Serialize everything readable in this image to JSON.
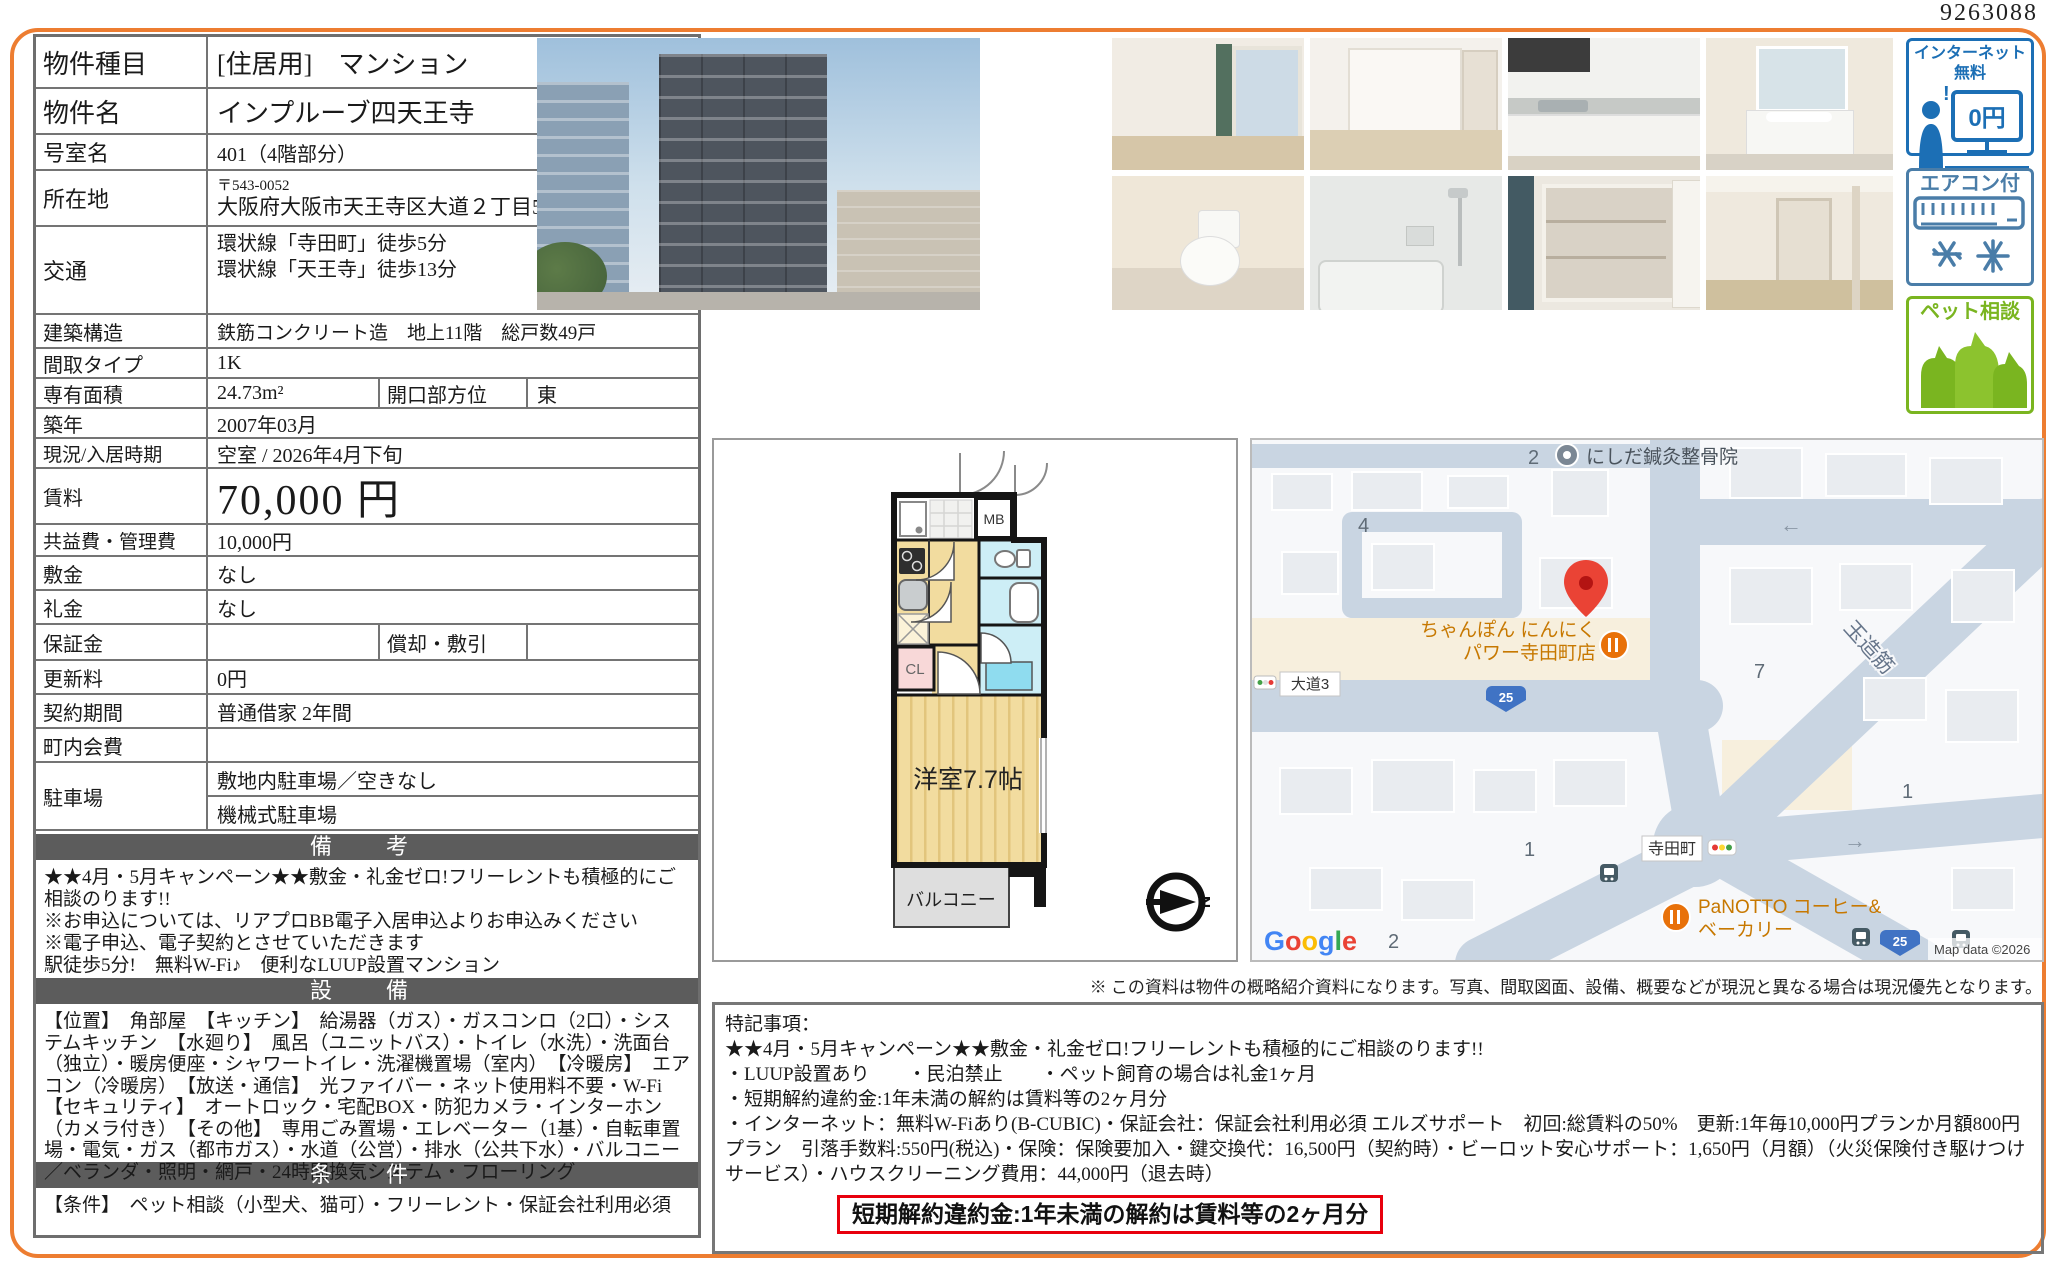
{
  "doc_number": "9263088",
  "table": {
    "property_type": {
      "label": "物件種目",
      "value": "[住居用]　マンション"
    },
    "property_name": {
      "label": "物件名",
      "value": "インプルーブ四天王寺"
    },
    "room_no": {
      "label": "号室名",
      "value": "401（4階部分）"
    },
    "address": {
      "label": "所在地",
      "postal": "〒543-0052",
      "value": "大阪府大阪市天王寺区大道２丁目5-3"
    },
    "access": {
      "label": "交通",
      "line1": "環状線「寺田町」徒歩5分",
      "line2": "環状線「天王寺」徒歩13分"
    },
    "structure": {
      "label": "建築構造",
      "value": "鉄筋コンクリート造　地上11階　総戸数49戸"
    },
    "layout_type": {
      "label": "間取タイプ",
      "value": "1K"
    },
    "area": {
      "label": "専有面積",
      "value": "24.73m²",
      "label2": "開口部方位",
      "value2": "東"
    },
    "built": {
      "label": "築年",
      "value": "2007年03月"
    },
    "status": {
      "label": "現況/入居時期",
      "value": "空室 /  2026年4月下旬"
    },
    "rent": {
      "label": "賃料",
      "value": "70,000 円"
    },
    "fees": {
      "label": "共益費・管理費",
      "value": "10,000円"
    },
    "deposit": {
      "label": "敷金",
      "value": "なし"
    },
    "key_money": {
      "label": "礼金",
      "value": "なし"
    },
    "guarantee": {
      "label": "保証金",
      "value": "",
      "label2": "償却・敷引",
      "value2": ""
    },
    "renewal_fee": {
      "label": "更新料",
      "value": "0円"
    },
    "contract": {
      "label": "契約期間",
      "value": "普通借家 2年間"
    },
    "town_fee": {
      "label": "町内会費",
      "value": ""
    },
    "parking": {
      "label": "駐車場",
      "value1": "敷地内駐車場／空きなし",
      "value2": "機械式駐車場"
    }
  },
  "sections": {
    "remarks_title": "備　考",
    "equipment_title": "設　備",
    "conditions_title": "条　件"
  },
  "remarks": {
    "lines": [
      "★★4月・5月キャンペーン★★敷金・礼金ゼロ!フリーレントも積極的にご相談のります!!",
      "※お申込については、リアプロBB電子入居申込よりお申込みください",
      "※電子申込、電子契約とさせていただきます",
      "駅徒歩5分!　無料W-Fi♪　便利なLUUP設置マンション"
    ]
  },
  "equipment": {
    "text": "【位置】　角部屋　【キッチン】　給湯器（ガス）・ガスコンロ（2口）・システムキッチン　【水廻り】　風呂（ユニットバス）・トイレ（水洗）・洗面台（独立）・暖房便座・シャワートイレ・洗濯機置場（室内）　【冷暖房】　エアコン（冷暖房）　【放送・通信】　光ファイバー・ネット使用料不要・W-Fi　【セキュリティ】　オートロック・宅配BOX・防犯カメラ・インターホン（カメラ付き）　【その他】　専用ごみ置場・エレベーター（1基）・自転車置場・電気・ガス（都市ガス）・水道（公営）・排水（公共下水）・バルコニー／ベランダ・照明・網戸・24時間換気システム・フローリング"
  },
  "conditions": {
    "text": "【条件】　ペット相談（小型犬、猫可）・フリーレント・保証会社利用必須"
  },
  "badges": {
    "internet": {
      "label": "インターネット無料",
      "monitor_text": "0円",
      "color": "#1c6fb5"
    },
    "aircon": {
      "label": "エアコン付",
      "color": "#4a7da8"
    },
    "pet": {
      "label": "ペット相談",
      "color": "#7ab520"
    }
  },
  "floor_plan": {
    "room": "洋室7.7帖",
    "balcony": "バルコニー",
    "closet": "CL",
    "meter_box": "MB",
    "compass": "N"
  },
  "map": {
    "clinic": "にしだ鍼灸整骨院",
    "restaurant_line1": "ちゃんぽん にんにく",
    "restaurant_line2": "パワー寺田町店",
    "road_label": "大道3",
    "route_number": "25",
    "road_name": "玉造筋",
    "station": "寺田町",
    "bakery_line1": "PaNOTTO コーヒー&",
    "bakery_line2": "ベーカリー",
    "numbers": {
      "n2a": "2",
      "n4": "4",
      "n7": "7",
      "n1a": "1",
      "n1b": "1",
      "n2b": "2"
    },
    "arrow_left": "←",
    "arrow_right": "→",
    "google_letters": [
      "G",
      "o",
      "o",
      "g",
      "l",
      "e"
    ],
    "copyright": "Map data ©2026"
  },
  "disclaimer": "※ この資料は物件の概略紹介資料になります。写真、間取図面、設備、概要などが現況と異なる場合は現況優先となります。",
  "special_notes": {
    "lines": [
      "特記事項：",
      "★★4月・5月キャンペーン★★敷金・礼金ゼロ!フリーレントも積極的にご相談のります!!",
      "・LUUP設置あり　　・民泊禁止　　・ペット飼育の場合は礼金1ヶ月",
      "・短期解約違約金:1年未満の解約は賃料等の2ヶ月分",
      "・インターネット：無料W-Fiあり(B-CUBIC)・保証会社：保証会社利用必須 エルズサポート　初回:総賃料の50%　更新:1年毎10,000円プランか月額800円プラン　引落手数料:550円(税込)・保険：保険要加入・鍵交換代：16,500円（契約時）・ビーロット安心サポート：1,650円（月額）（火災保険付き駆けつけサービス）・ハウスクリーニング費用：44,000円（退去時）"
    ]
  },
  "highlight": "短期解約違約金:1年未満の解約は賃料等の2ヶ月分",
  "colors": {
    "accent_orange": "#ed7d31",
    "header_gray": "#5c5c5c",
    "highlight_red": "#e8000d"
  }
}
